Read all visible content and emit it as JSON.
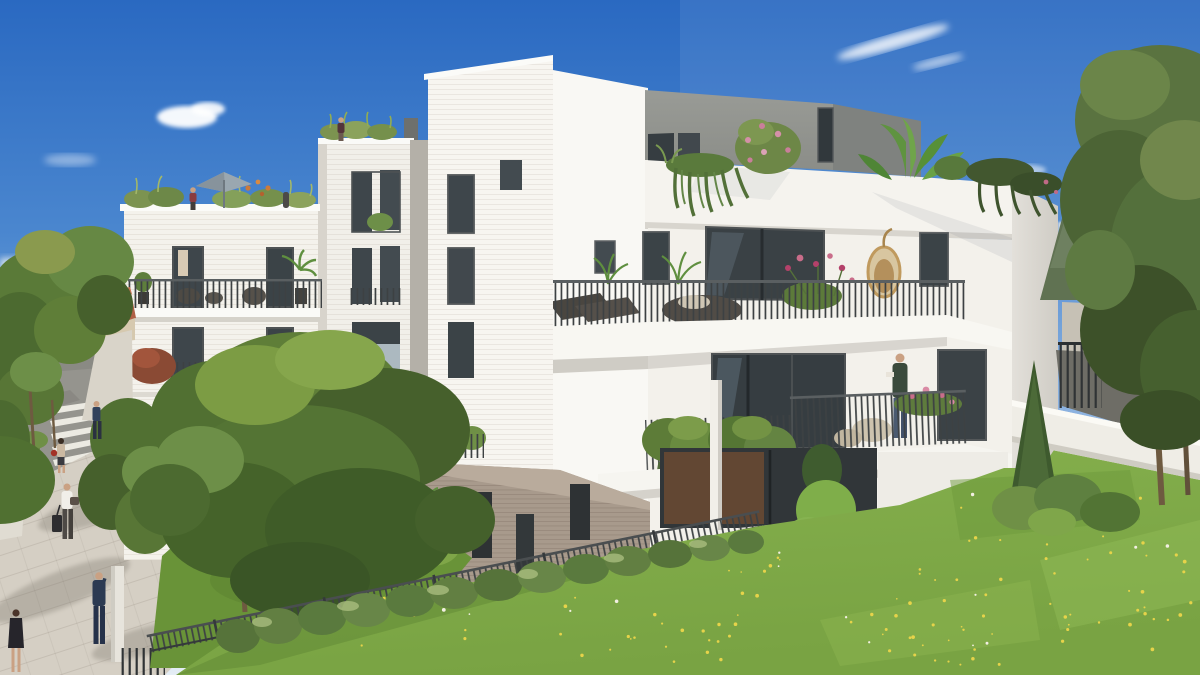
{
  "scene": {
    "kind": "architectural rendering",
    "description": "Modern white residential apartment complex with planted terraces, rooftop gardens, front lawn and street promenade on a sunny day",
    "palette": {
      "sky_top": "#2a69c1",
      "sky_mid": "#7cabdd",
      "sky_horizon": "#e4edf5",
      "cloud": "#ffffff",
      "wall_bright": "#f9f8f4",
      "wall_lit": "#f3f1eb",
      "wall_mid": "#e9e6e0",
      "wall_shade": "#dbd8d2",
      "wall_deep": "#c9c6c0",
      "gray_block": "#93958f",
      "gray_block_side": "#7f827f",
      "glass_dark": "#3e464b",
      "glass_deeper": "#31383c",
      "frame": "#54585a",
      "warm_interior": "#6b4a33",
      "railing": "#3d4143",
      "rail_top": "#5a5f61",
      "base_brick": "#a89a8c",
      "roof_terracotta": "#b06046",
      "house_wall": "#d6c9af",
      "road": "#95948e",
      "sidewalk": "#d5cfc4",
      "crosswalk": "#eceae2",
      "planter": "#ece8df",
      "car_red": "#8e2f2a",
      "ramp": "#6e6d66",
      "white_wall": "#efede6",
      "lawn": "#7ca646",
      "lawn_light": "#8fba55",
      "lawn_shade": "#699338",
      "hedge": "#627f42",
      "hedge_light": "#7e9b55",
      "tree_green": "#5f7e38",
      "tree_dark": "#46602c",
      "tree_light": "#7c9c44",
      "right_tree": "#5a7340",
      "right_tree_dark": "#3d5129",
      "spruce": "#607252",
      "cypress": "#3e5a2e",
      "trunk": "#6e5a40",
      "dandelion": "#e6d34a",
      "flower_pink": "#c96d8a",
      "flower_red": "#b4416a",
      "plant_red": "#a84532",
      "flower_orange": "#cc7a3a",
      "wicker": "#b8925c",
      "wicker_dark": "#55504a",
      "cushion": "#ddd5c4",
      "egg_chair": "#c09a5e",
      "parasol": "#9aa7b0",
      "suit_navy": "#2c3a52",
      "shirt_white": "#f1efe9",
      "skin": "#caa183",
      "bag_red": "#a33226",
      "dress_black": "#26252b",
      "jeans": "#4a5a70",
      "sweater_green": "#3a4a3c",
      "panel_blue": "#b9c6cd"
    },
    "people": {
      "street": [
        "man crossing the crosswalk",
        "woman with red handbag",
        "man pulling rolling suitcase",
        "man in navy suit on phone",
        "woman in black dress"
      ],
      "balcony": [
        "man holding a mug on first-floor balcony"
      ],
      "rooftop": [
        "woman on left rooftop terrace",
        "person beside parasol",
        "woman on middle rooftop"
      ]
    },
    "landscape_items": [
      "front lawn with dandelions",
      "boxwood hedge",
      "metal garden fence",
      "large foreground tree",
      "cypress",
      "right-side trees",
      "retaining wall",
      "access ramp"
    ]
  }
}
